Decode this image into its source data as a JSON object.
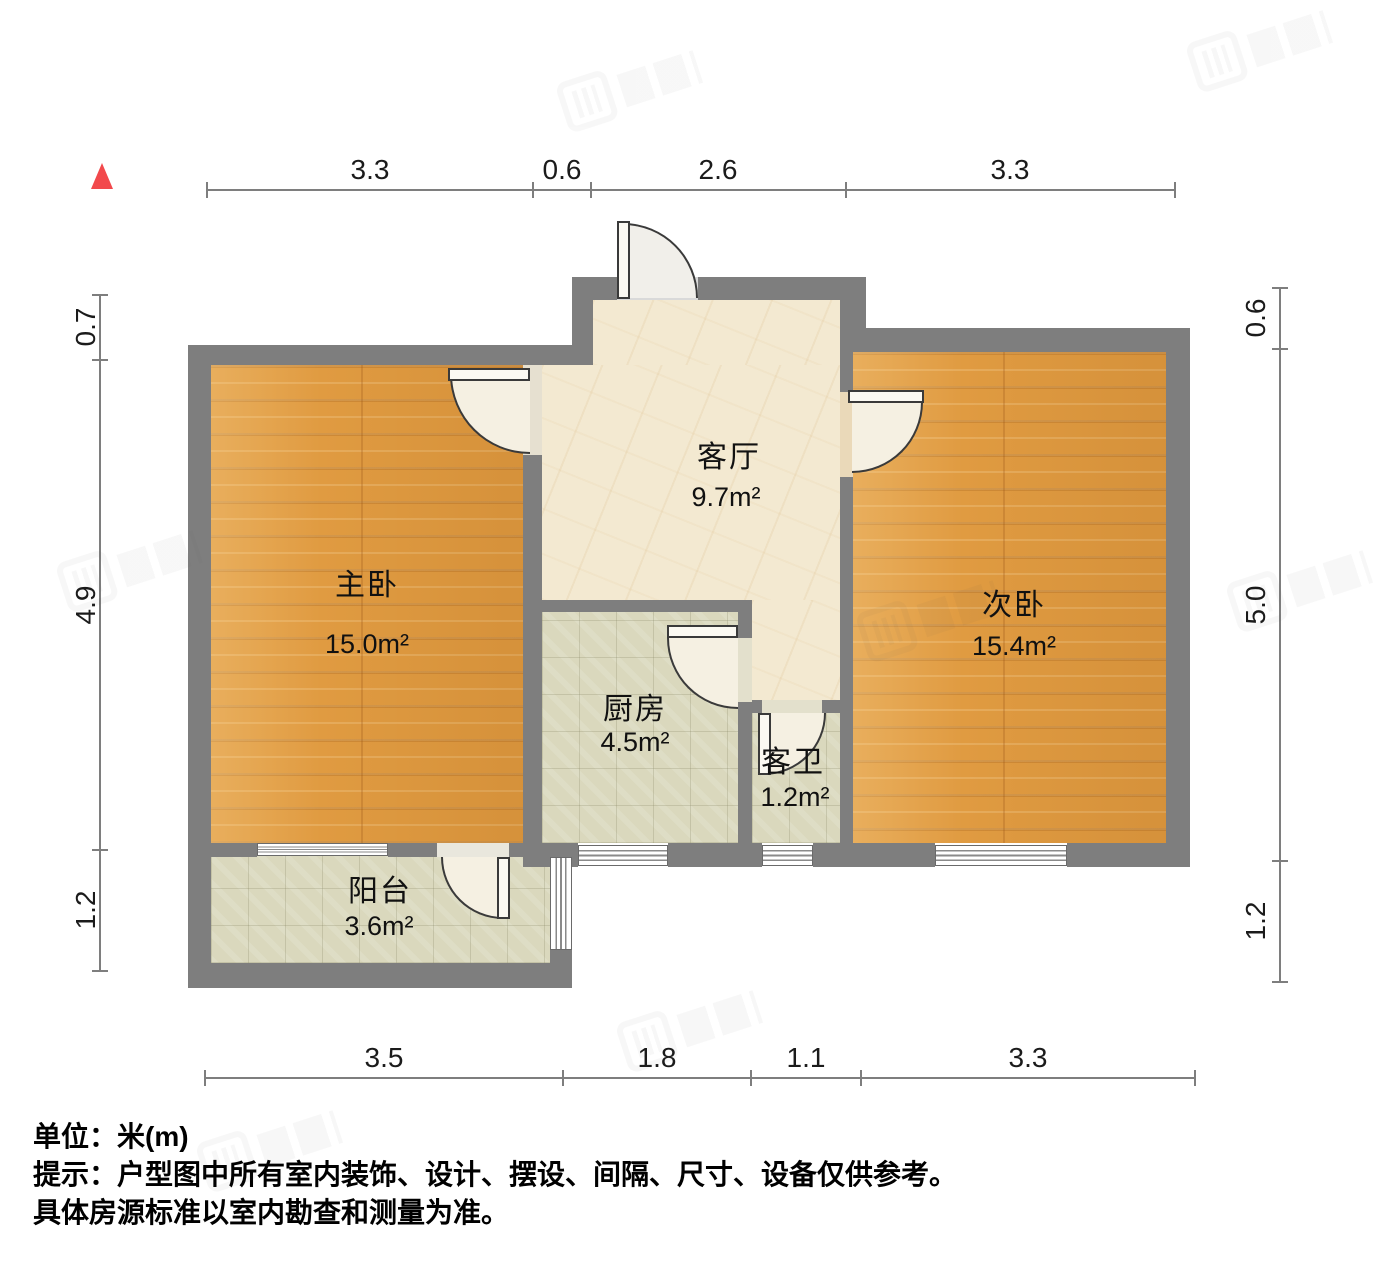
{
  "rooms": {
    "master_bedroom": {
      "name": "主卧",
      "area": "15.0m²"
    },
    "living_room": {
      "name": "客厅",
      "area": "9.7m²"
    },
    "second_bedroom": {
      "name": "次卧",
      "area": "15.4m²"
    },
    "kitchen": {
      "name": "厨房",
      "area": "4.5m²"
    },
    "guest_bathroom": {
      "name": "客卫",
      "area": "1.2m²"
    },
    "balcony": {
      "name": "阳台",
      "area": "3.6m²"
    }
  },
  "dimensions": {
    "top": [
      "3.3",
      "0.6",
      "2.6",
      "3.3"
    ],
    "bottom": [
      "3.5",
      "1.8",
      "1.1",
      "3.3"
    ],
    "left": [
      "0.7",
      "4.9",
      "1.2"
    ],
    "right": [
      "0.6",
      "5.0",
      "1.2"
    ]
  },
  "notes": {
    "unit": "单位：米(m)",
    "line1": "提示：户型图中所有室内装饰、设计、摆设、间隔、尺寸、设备仅供参考。",
    "line2": "具体房源标准以室内勘查和测量为准。"
  },
  "colors": {
    "wall": "#7E7E7E",
    "wood_floor": "#E09B41",
    "marble_floor": "#F3E9D1",
    "tile_floor": "#DAD8BD",
    "north_marker_red": "#F2494C",
    "dimension_line": "#7E7E7E"
  }
}
